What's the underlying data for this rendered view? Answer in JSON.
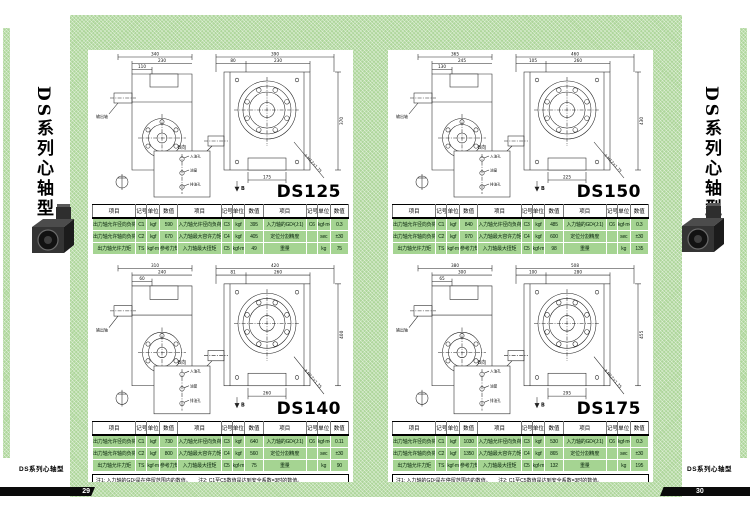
{
  "theme": {
    "panel_green": "#aed69b",
    "table_row_green": "#a5d492",
    "page_bar_black": "#0a0a0a",
    "line_color": "#222222"
  },
  "table_headers": [
    "项目",
    "记号",
    "单位",
    "数值",
    "项目",
    "记号",
    "单位",
    "数值",
    "项目",
    "记号",
    "单位",
    "数值"
  ],
  "pages": [
    {
      "page_number": "29",
      "sidebar_title": "DS系列心轴型",
      "footer": "DS系列心轴型",
      "note": "注1: 入力轴的GD²是在停留范围内的数值。　　注2: C1至C5数值是达到安全系数=3时的数值。",
      "sections": [
        {
          "title": "DS125",
          "drawing": {
            "view1": {
              "d1": "340",
              "d2": "230",
              "d3": "110",
              "shaft_label": "输出轴"
            },
            "view2": {
              "d1": "390",
              "d2": "230",
              "d3": "80",
              "height": "370",
              "bottom": "175",
              "shaft_label": "输入轴",
              "callout": "4-M12×1.75",
              "view_mark": "B"
            },
            "bview": {
              "label": "B向",
              "hole1": "入油孔",
              "hole2": "油窗",
              "hole3": "排油孔"
            }
          },
          "table": {
            "rows": [
              [
                "出力轴允许径向负荷",
                "C1",
                "kgf",
                "590",
                "入力轴允许径向负荷",
                "C3",
                "kgf",
                "395",
                "入力轴的GD²(J:1)",
                "C6",
                "kgf·m²",
                "0.3"
              ],
              [
                "出力轴允许轴向负荷",
                "C2",
                "kgf",
                "670",
                "入力轴最大容许力矩",
                "C4",
                "kgf",
                "405",
                "定位分割精度",
                "",
                "sec",
                "±30"
              ],
              [
                "出力轴允许力矩",
                "TS",
                "kgf·m",
                "参考力矩表",
                "入力轴最大扭矩",
                "C5",
                "kgf·m",
                "49",
                "重量",
                "",
                "kg",
                "75"
              ]
            ]
          }
        },
        {
          "title": "DS140",
          "drawing": {
            "view1": {
              "d1": "310",
              "d2": "240",
              "d3": "60",
              "shaft_label": "输出轴"
            },
            "view2": {
              "d1": "420",
              "d2": "260",
              "d3": "81",
              "height": "400",
              "bottom": "260",
              "shaft_label": "输入轴",
              "callout": "4-M12×1.75",
              "view_mark": "B"
            },
            "bview": {
              "label": "B向",
              "hole1": "入油孔",
              "hole2": "油窗",
              "hole3": "排油孔"
            }
          },
          "table": {
            "rows": [
              [
                "出力轴允许径向负荷",
                "C1",
                "kgf",
                "730",
                "入力轴允许径向负荷",
                "C3",
                "kgf",
                "640",
                "入力轴的GD²(J:1)",
                "C6",
                "kgf·m²",
                "0.11"
              ],
              [
                "出力轴允许轴向负荷",
                "C2",
                "kgf",
                "800",
                "入力轴最大容许力矩",
                "C4",
                "kgf",
                "560",
                "定位分割精度",
                "",
                "sec",
                "±30"
              ],
              [
                "出力轴允许力矩",
                "TS",
                "kgf·m",
                "参考力矩表",
                "入力轴最大扭矩",
                "C5",
                "kgf·m",
                "75",
                "重量",
                "",
                "kg",
                "90"
              ]
            ]
          }
        }
      ]
    },
    {
      "page_number": "30",
      "sidebar_title": "DS系列心轴型",
      "footer": "DS系列心轴型",
      "note": "注1: 入力轴的GD²是在停留范围内的数值。　　注2: C1至C5数值是达到安全系数=3时的数值。",
      "sections": [
        {
          "title": "DS150",
          "drawing": {
            "view1": {
              "d1": "365",
              "d2": "245",
              "d3": "130",
              "shaft_label": "输出轴"
            },
            "view2": {
              "d1": "460",
              "d2": "260",
              "d3": "105",
              "height": "430",
              "bottom": "225",
              "shaft_label": "输入轴",
              "callout": "4-M12×1.75",
              "view_mark": "B"
            },
            "bview": {
              "label": "B向",
              "hole1": "入油孔",
              "hole2": "油窗",
              "hole3": "排油孔"
            }
          },
          "table": {
            "rows": [
              [
                "出力轴允许径向负荷",
                "C1",
                "kgf",
                "840",
                "入力轴允许径向负荷",
                "C3",
                "kgf",
                "485",
                "入力轴的GD²(J:1)",
                "C6",
                "kgf·m²",
                "0.3"
              ],
              [
                "出力轴允许轴向负荷",
                "C2",
                "kgf",
                "970",
                "入力轴最大容许力矩",
                "C4",
                "kgf",
                "600",
                "定位分割精度",
                "",
                "sec",
                "±30"
              ],
              [
                "出力轴允许力矩",
                "TS",
                "kgf·m",
                "参考力矩表",
                "入力轴最大扭矩",
                "C5",
                "kgf·m",
                "98",
                "重量",
                "",
                "kg",
                "135"
              ]
            ]
          }
        },
        {
          "title": "DS175",
          "drawing": {
            "view1": {
              "d1": "380",
              "d2": "300",
              "d3": "65",
              "shaft_label": "输出轴"
            },
            "view2": {
              "d1": "508",
              "d2": "280",
              "d3": "100",
              "height": "455",
              "bottom": "295",
              "shaft_label": "输入轴",
              "callout": "4-M12×1.75",
              "view_mark": "B"
            },
            "bview": {
              "label": "B向",
              "hole1": "入油孔",
              "hole2": "油窗",
              "hole3": "排油孔"
            }
          },
          "table": {
            "rows": [
              [
                "出力轴允许径向负荷",
                "C1",
                "kgf",
                "1030",
                "入力轴允许径向负荷",
                "C3",
                "kgf",
                "530",
                "入力轴的GD²(J:1)",
                "C6",
                "kgf·m²",
                "0.3"
              ],
              [
                "出力轴允许轴向负荷",
                "C2",
                "kgf",
                "1350",
                "入力轴最大容许力矩",
                "C4",
                "kgf",
                "865",
                "定位分割精度",
                "",
                "sec",
                "±30"
              ],
              [
                "出力轴允许力矩",
                "TS",
                "kgf·m",
                "参考力矩表",
                "入力轴最大扭矩",
                "C5",
                "kgf·m",
                "132",
                "重量",
                "",
                "kg",
                "195"
              ]
            ]
          }
        }
      ]
    }
  ]
}
